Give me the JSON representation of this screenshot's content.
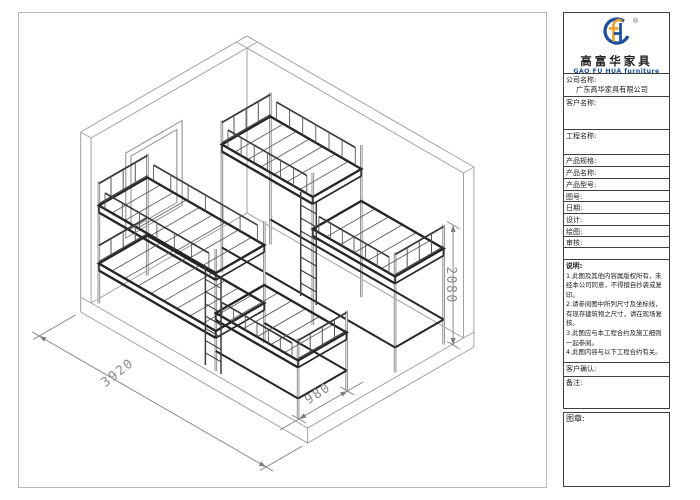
{
  "drawing": {
    "dim_length": "3920",
    "dim_width": "980",
    "dim_height": "2080"
  },
  "logo": {
    "brand_cn": "高富华家具",
    "brand_en": "GAO FU HUA furniture",
    "registered_mark": "®"
  },
  "title_block": {
    "company_label": "公司名称:",
    "company_value": "广东高华家具有限公司",
    "customer_label": "客户名称:",
    "project_label": "工程名称:",
    "spec_label": "产品规格:",
    "product_label": "产品名称:",
    "model_label": "产品型号:",
    "drawing_no_label": "图号:",
    "date_label": "日期:",
    "design_label": "设计:",
    "draft_label": "绘图:",
    "audit_label": "审核:",
    "notes_title": "说明:",
    "notes": [
      "1.此图及其他内容属版权所有，未",
      "经本公司同意，不得擅自抄袭或复",
      "印。",
      "2.请参阅图中所列尺寸及坐标线，",
      "有现存建筑物之尺寸，请在现场复",
      "核。",
      "3.此图应与本工程合约及施工细则",
      "一起参阅。",
      "4.此图内容与以下工程合约有关。"
    ],
    "confirm_label": "客户确认:",
    "remark_label": "备注:",
    "stamp_label": "图章:"
  },
  "colors": {
    "brand_blue": "#1d4f9e",
    "brand_gold": "#eca32e"
  }
}
